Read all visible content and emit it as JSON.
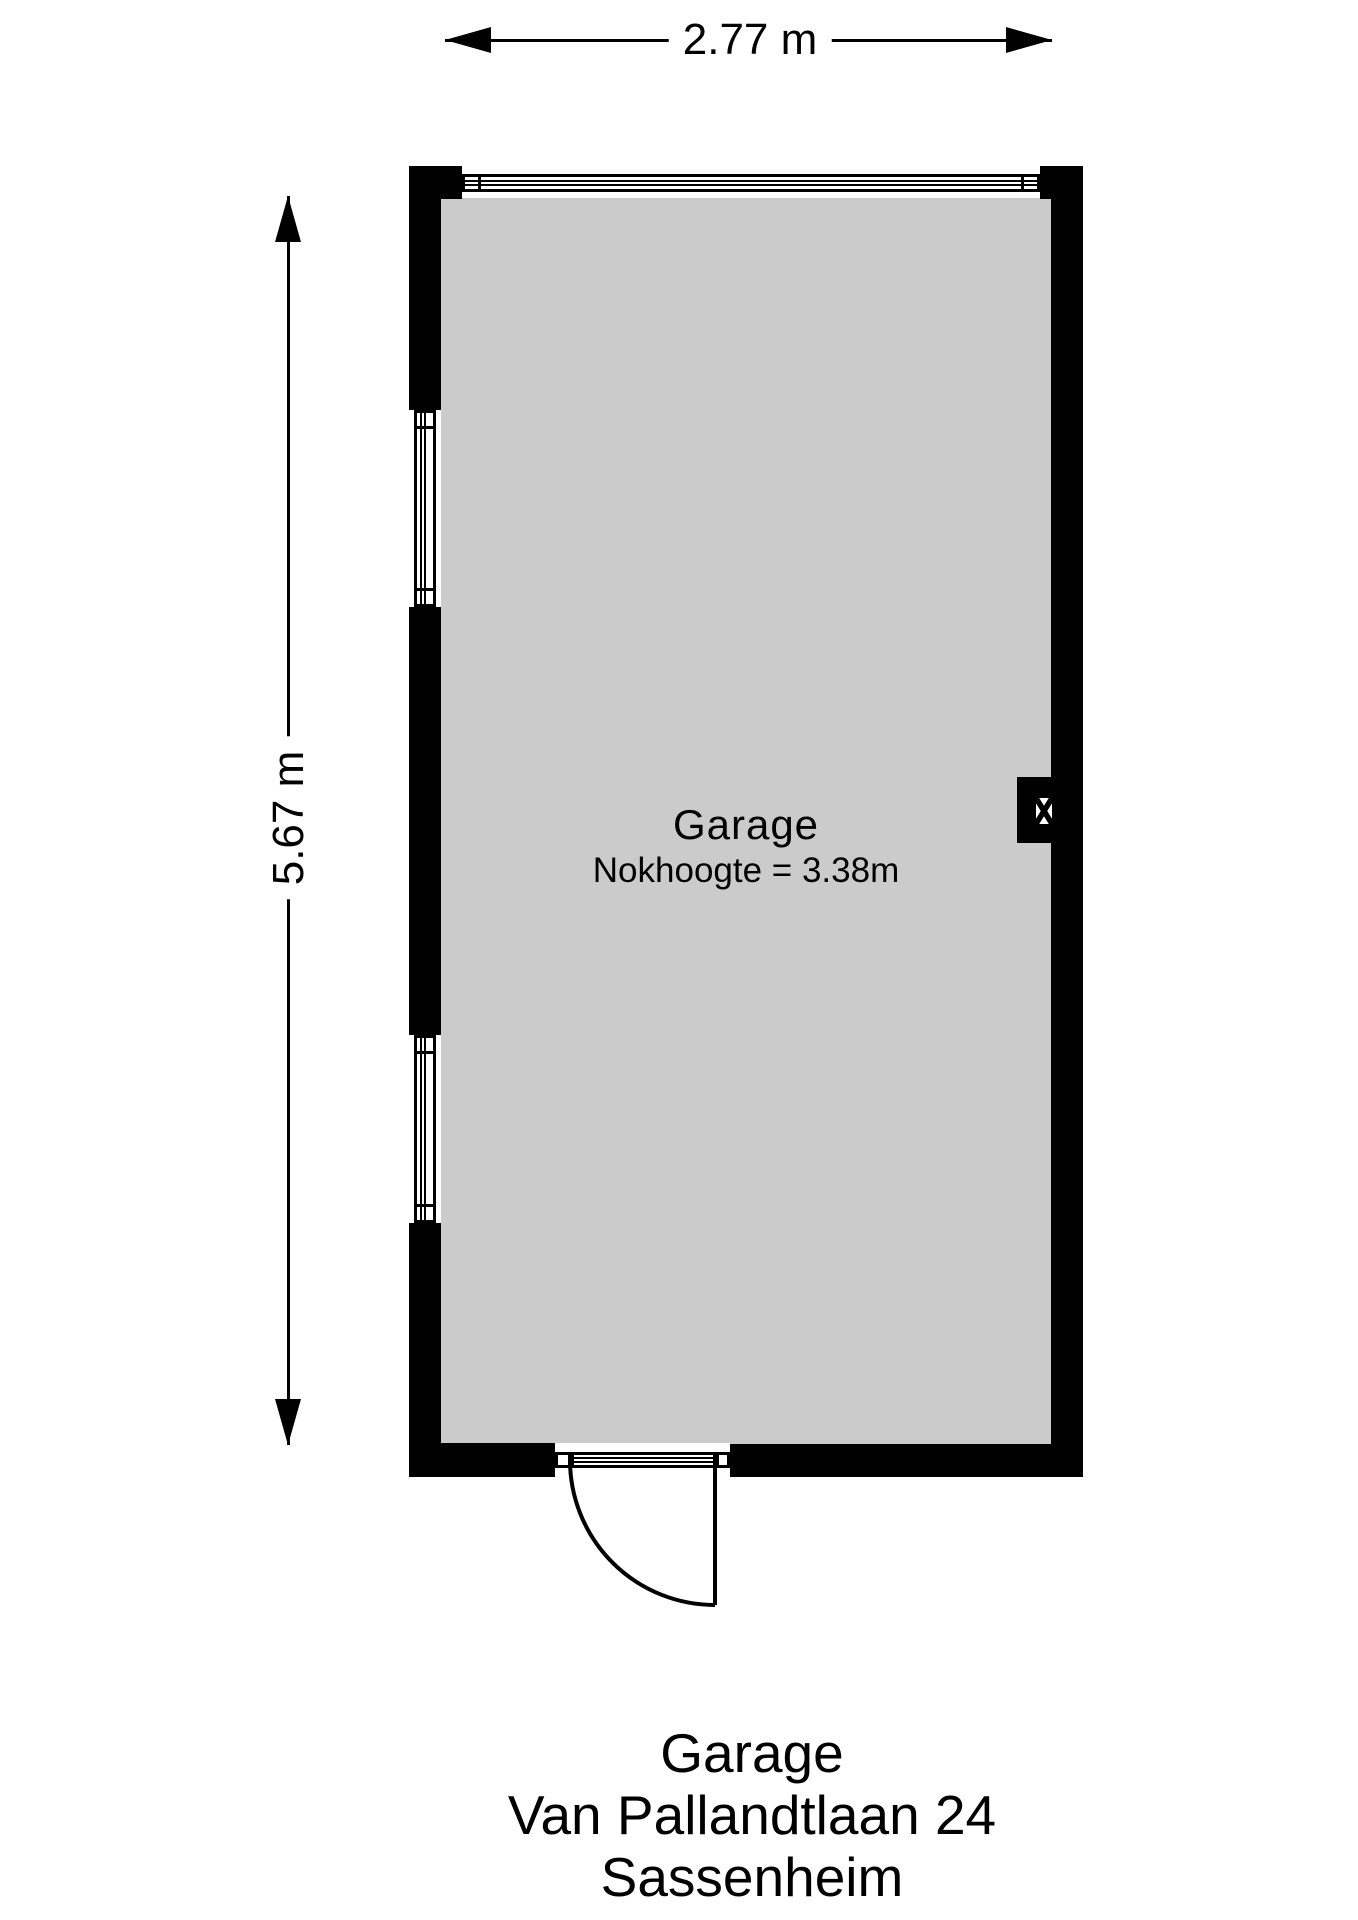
{
  "dimensions": {
    "width_label": "2.77 m",
    "height_label": "5.67 m"
  },
  "room": {
    "name": "Garage",
    "ridge_height": "Nokhoogte = 3.38m"
  },
  "caption": {
    "lines": [
      "Garage",
      "Van Pallandtlaan 24",
      "Sassenheim"
    ]
  },
  "icons": {
    "dimension_arrowheads": "filled-triangle",
    "flue": "white-square-with-black-diagonal-cross"
  },
  "colors": {
    "wall": "#000000",
    "floor": "#cbcbcb",
    "background": "#ffffff"
  }
}
